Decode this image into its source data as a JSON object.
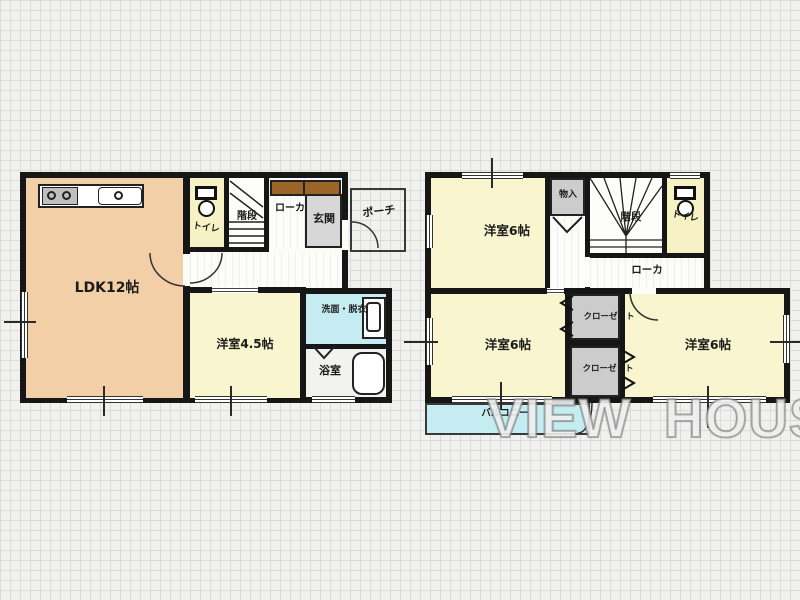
{
  "watermark": "VIEW HOUSE",
  "colors": {
    "wall": "#161616",
    "ldk_floor": "#F2CFA6",
    "room_floor": "#F8F5CF",
    "wet_area_cyan": "#C5EDF1",
    "entrance_gray": "#D7D7D7",
    "closet_gray": "#CCCCCC",
    "shoe_cabinet_brown": "#9A6526"
  },
  "floor1": {
    "ldk": "LDK12帖",
    "toilet": "トイレ",
    "stairs": "階段",
    "hallway": "ローカ",
    "entrance": "玄関",
    "porch": "ポーチ",
    "bedroom": "洋室4.5帖",
    "washroom": "洗面・脱衣",
    "bathroom": "浴室"
  },
  "floor2": {
    "bedroom_nw": "洋室6帖",
    "storage": "物入",
    "stairs": "階段",
    "toilet": "トイレ",
    "hallway": "ローカ",
    "bedroom_sw": "洋室6帖",
    "closet_a": "クローゼット",
    "closet_b": "クローゼット",
    "bedroom_se": "洋室6帖",
    "balcony": "バルコニー"
  }
}
